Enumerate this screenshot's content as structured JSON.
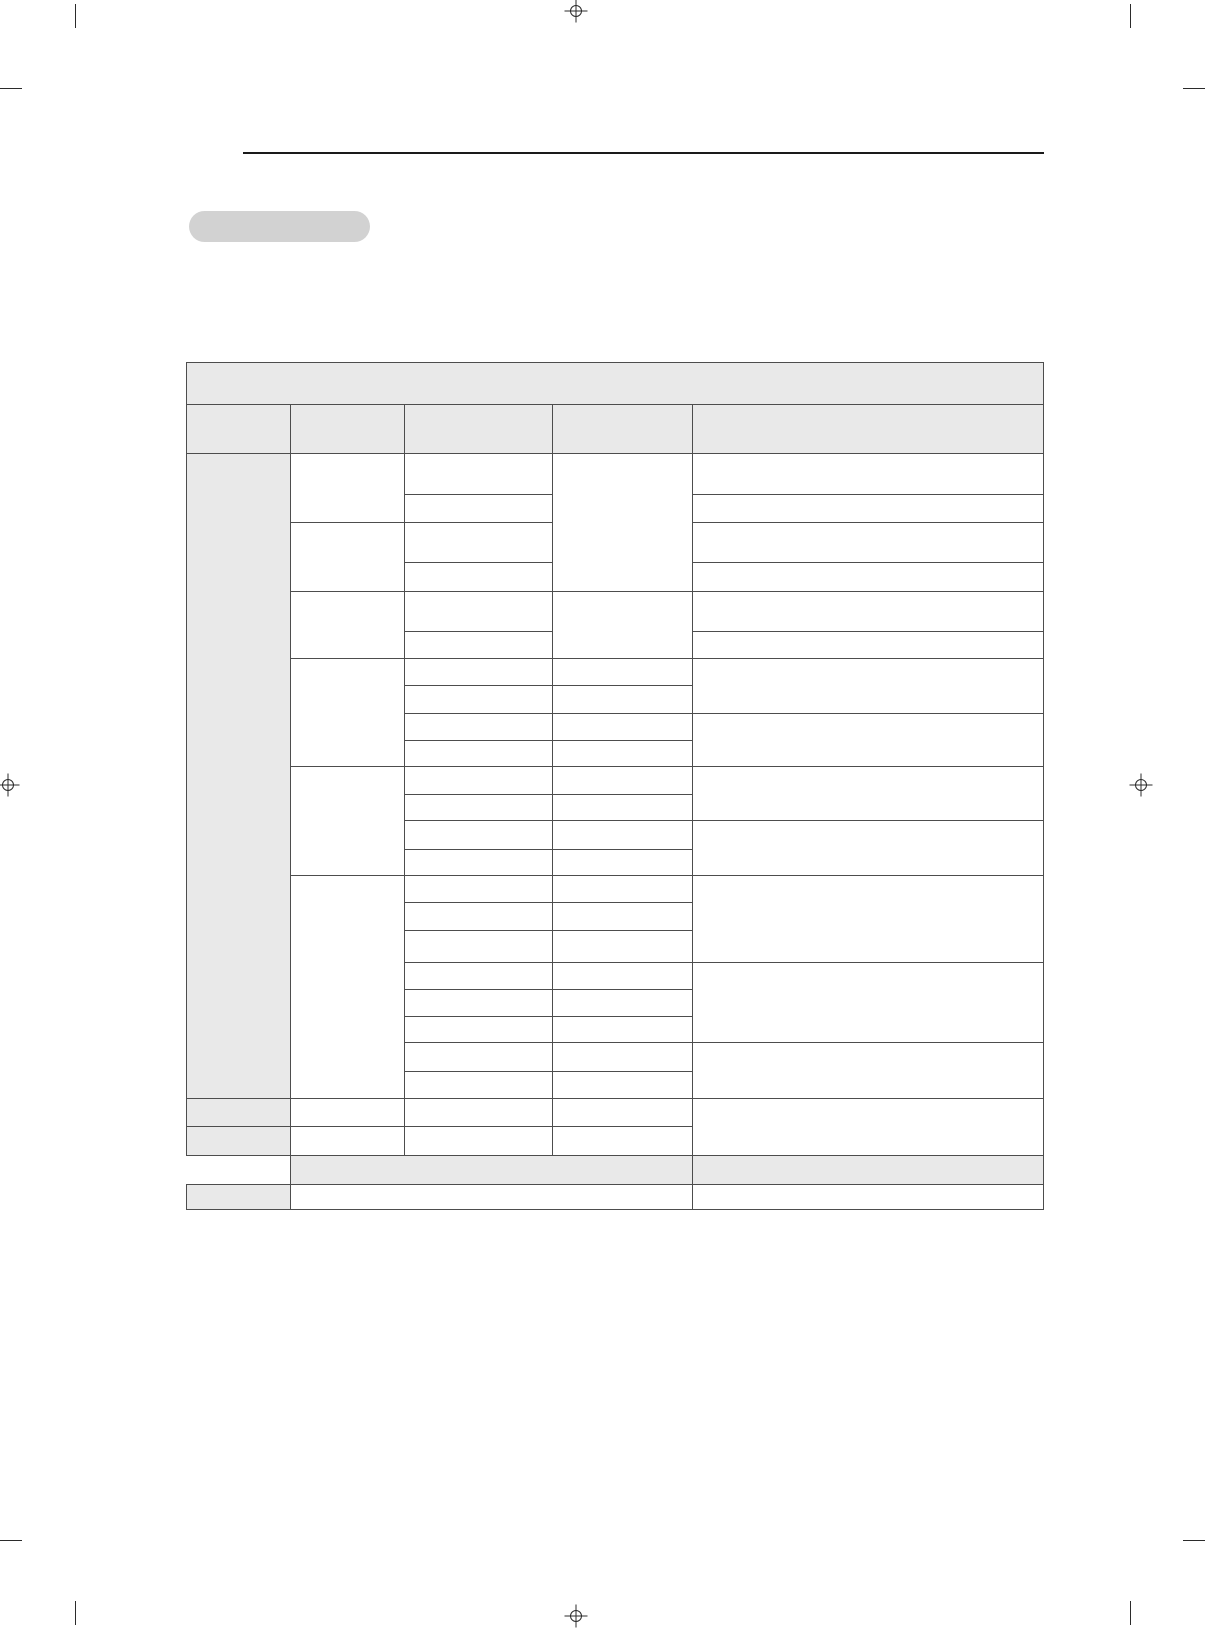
{
  "page": {
    "width": 1205,
    "height": 1630,
    "background": "#ffffff"
  },
  "print_marks": {
    "color": "#2b2b2b",
    "crosshairs": [
      {
        "name": "registration-crosshair-top-center",
        "cx": 576,
        "cy": 11
      },
      {
        "name": "registration-crosshair-bottom-center",
        "cx": 576,
        "cy": 1616
      },
      {
        "name": "registration-crosshair-left-middle",
        "cx": 8,
        "cy": 785
      },
      {
        "name": "registration-crosshair-right-middle",
        "cx": 1141,
        "cy": 785
      }
    ],
    "ticks": [
      {
        "name": "crop-tick-top-left-vertical",
        "x": 75,
        "y": 4,
        "dir": "v"
      },
      {
        "name": "crop-tick-top-left-horizontal",
        "x": 0,
        "y": 88,
        "dir": "h"
      },
      {
        "name": "crop-tick-top-right-vertical",
        "x": 1130,
        "y": 4,
        "dir": "v"
      },
      {
        "name": "crop-tick-top-right-horizontal",
        "x": 1183,
        "y": 88,
        "dir": "h"
      },
      {
        "name": "crop-tick-bottom-left-vertical",
        "x": 75,
        "y": 1601,
        "dir": "v"
      },
      {
        "name": "crop-tick-bottom-left-horizontal",
        "x": 0,
        "y": 1540,
        "dir": "h"
      },
      {
        "name": "crop-tick-bottom-right-vertical",
        "x": 1130,
        "y": 1601,
        "dir": "v"
      },
      {
        "name": "crop-tick-bottom-right-horizontal",
        "x": 1183,
        "y": 1540,
        "dir": "h"
      }
    ]
  },
  "header": {
    "rule_color": "#1a1a1a",
    "section_pill": {
      "label": "",
      "fill": "#d2d2d2"
    }
  },
  "table": {
    "fill_gray": "#e9e9e9",
    "border_color": "#4d4d4d",
    "x": 186,
    "y": 362,
    "width": 858,
    "column_widths": [
      104,
      114,
      148,
      140,
      351
    ],
    "all_cells_empty": true,
    "rows": [
      {
        "h": 42,
        "cells": [
          {
            "cs": 5,
            "fill": "gray"
          }
        ]
      },
      {
        "h": 49,
        "cells": [
          {
            "fill": "gray"
          },
          {
            "fill": "gray"
          },
          {
            "fill": "gray"
          },
          {
            "fill": "gray"
          },
          {
            "fill": "gray"
          }
        ]
      },
      {
        "h": 41,
        "cells": [
          {
            "fill": "gray",
            "rs": 22
          },
          {
            "rs": 2
          },
          {},
          {
            "rs": 4
          },
          {}
        ]
      },
      {
        "h": 28,
        "cells": [
          {},
          {}
        ]
      },
      {
        "h": 40,
        "cells": [
          {
            "rs": 2
          },
          {},
          {}
        ]
      },
      {
        "h": 29,
        "cells": [
          {},
          {}
        ]
      },
      {
        "h": 40,
        "cells": [
          {
            "rs": 2
          },
          {},
          {
            "rs": 2
          },
          {}
        ]
      },
      {
        "h": 27,
        "cells": [
          {},
          {}
        ]
      },
      {
        "h": 27,
        "cells": [
          {
            "rs": 4
          },
          {},
          {},
          {
            "rs": 2
          }
        ]
      },
      {
        "h": 28,
        "cells": [
          {},
          {}
        ]
      },
      {
        "h": 27,
        "cells": [
          {},
          {},
          {
            "rs": 2
          }
        ]
      },
      {
        "h": 26,
        "cells": [
          {},
          {}
        ]
      },
      {
        "h": 28,
        "cells": [
          {
            "rs": 4
          },
          {},
          {},
          {
            "rs": 2
          }
        ]
      },
      {
        "h": 26,
        "cells": [
          {},
          {}
        ]
      },
      {
        "h": 29,
        "cells": [
          {},
          {},
          {
            "rs": 2
          }
        ]
      },
      {
        "h": 26,
        "cells": [
          {},
          {}
        ]
      },
      {
        "h": 27,
        "cells": [
          {
            "rs": 8
          },
          {},
          {},
          {
            "rs": 3
          }
        ]
      },
      {
        "h": 28,
        "cells": [
          {},
          {}
        ]
      },
      {
        "h": 32,
        "cells": [
          {},
          {}
        ]
      },
      {
        "h": 27,
        "cells": [
          {},
          {},
          {
            "rs": 3
          }
        ]
      },
      {
        "h": 27,
        "cells": [
          {},
          {}
        ]
      },
      {
        "h": 26,
        "cells": [
          {},
          {}
        ]
      },
      {
        "h": 29,
        "cells": [
          {},
          {},
          {
            "rs": 2
          }
        ]
      },
      {
        "h": 27,
        "cells": [
          {},
          {}
        ]
      },
      {
        "h": 28,
        "cells": [
          {
            "fill": "gray"
          },
          {},
          {},
          {},
          {
            "rs": 2
          }
        ]
      },
      {
        "h": 29,
        "cells": [
          {
            "fill": "gray"
          },
          {},
          {},
          {}
        ]
      },
      {
        "h": 29,
        "cells": [
          {
            "ghost": true
          },
          {
            "cs": 3,
            "fill": "gray"
          },
          {
            "fill": "gray"
          }
        ]
      },
      {
        "h": 25,
        "cells": [
          {
            "fill": "gray"
          },
          {
            "cs": 3
          },
          {}
        ]
      }
    ]
  }
}
